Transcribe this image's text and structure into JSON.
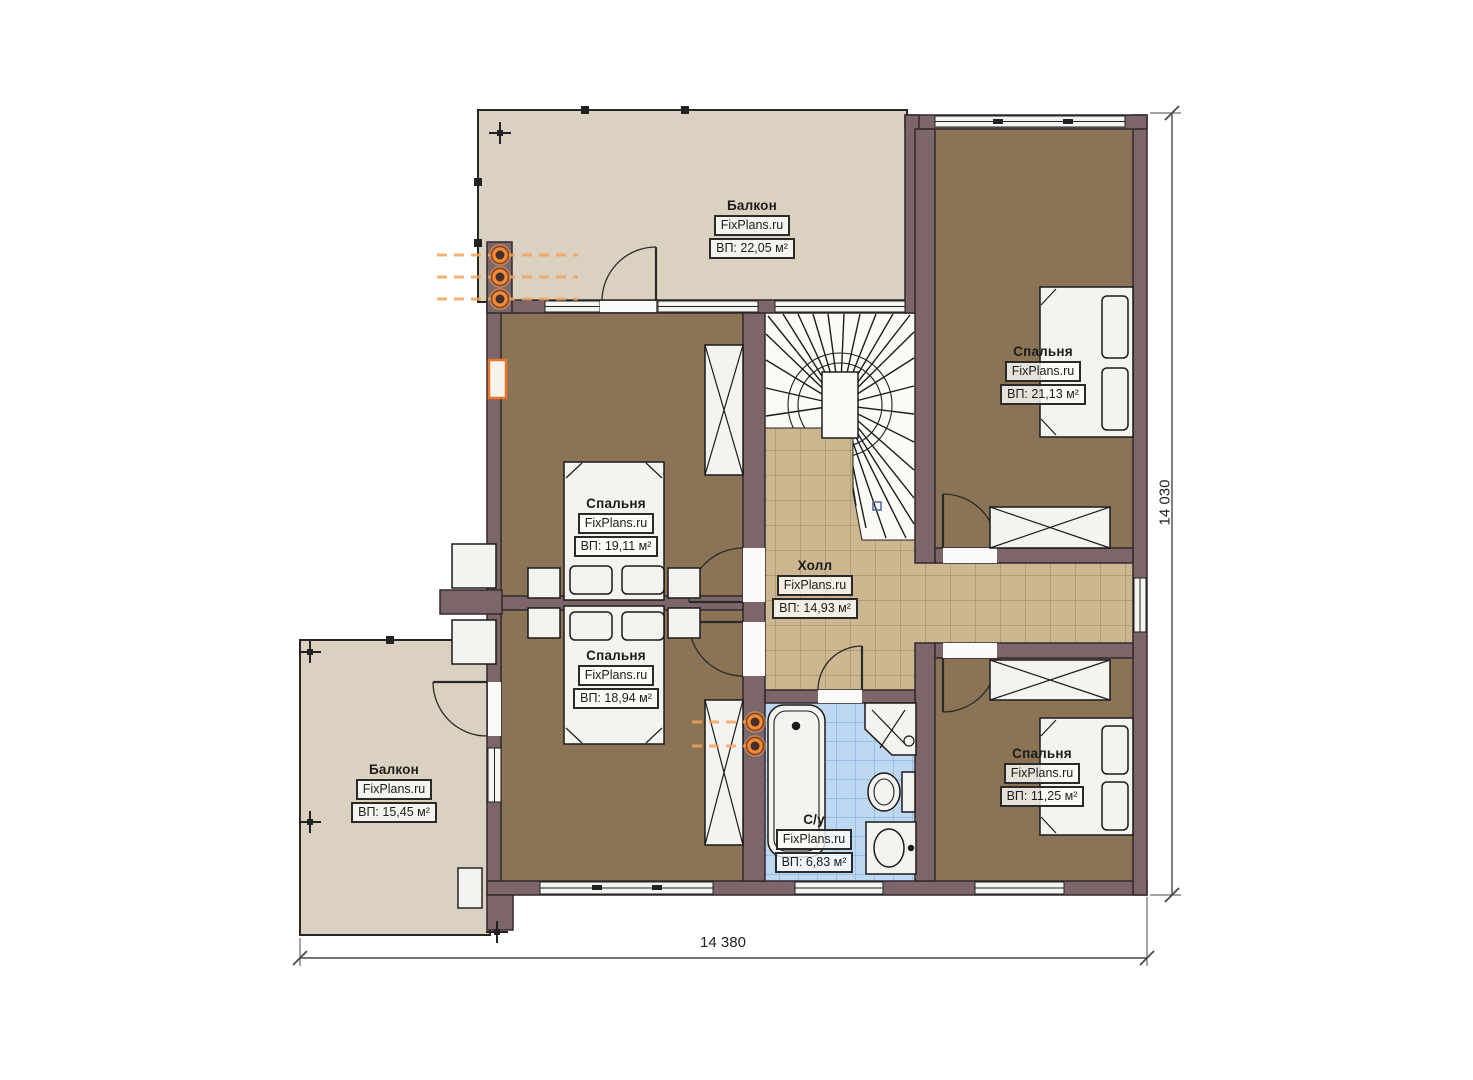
{
  "rooms": [
    {
      "id": "balcony-top",
      "name": "Балкон",
      "brand": "FixPlans.ru",
      "area": "ВП: 22,05 м²"
    },
    {
      "id": "bedroom-top-right",
      "name": "Спальня",
      "brand": "FixPlans.ru",
      "area": "ВП: 21,13 м²"
    },
    {
      "id": "bedroom-left-upper",
      "name": "Спальня",
      "brand": "FixPlans.ru",
      "area": "ВП: 19,11 м²"
    },
    {
      "id": "hall",
      "name": "Холл",
      "brand": "FixPlans.ru",
      "area": "ВП: 14,93 м²"
    },
    {
      "id": "bedroom-left-lower",
      "name": "Спальня",
      "brand": "FixPlans.ru",
      "area": "ВП: 18,94 м²"
    },
    {
      "id": "balcony-bottom-left",
      "name": "Балкон",
      "brand": "FixPlans.ru",
      "area": "ВП: 15,45 м²"
    },
    {
      "id": "bathroom",
      "name": "С/у",
      "brand": "FixPlans.ru",
      "area": "ВП: 6,83 м²"
    },
    {
      "id": "bedroom-bottom-right",
      "name": "Спальня",
      "brand": "FixPlans.ru",
      "area": "ВП: 11,25 м²"
    }
  ],
  "dimensions": {
    "width_label": "14 380",
    "height_label": "14 030"
  },
  "colors": {
    "background": "#ffffff",
    "wall": "#7c666a",
    "wall_outline": "#33292e",
    "balcony_floor": "#dbd1c1",
    "bedroom_floor": "#8b7456",
    "hall_tile": "#cdb790",
    "hall_tile_grid": "#a28c64",
    "bath_tile": "#bfd8f2",
    "bath_tile_grid": "#84aeda",
    "fixture_fill": "#f4f3ef",
    "radiator_accent": "#ef8b3a",
    "dimension_line": "#4a4a4a"
  }
}
